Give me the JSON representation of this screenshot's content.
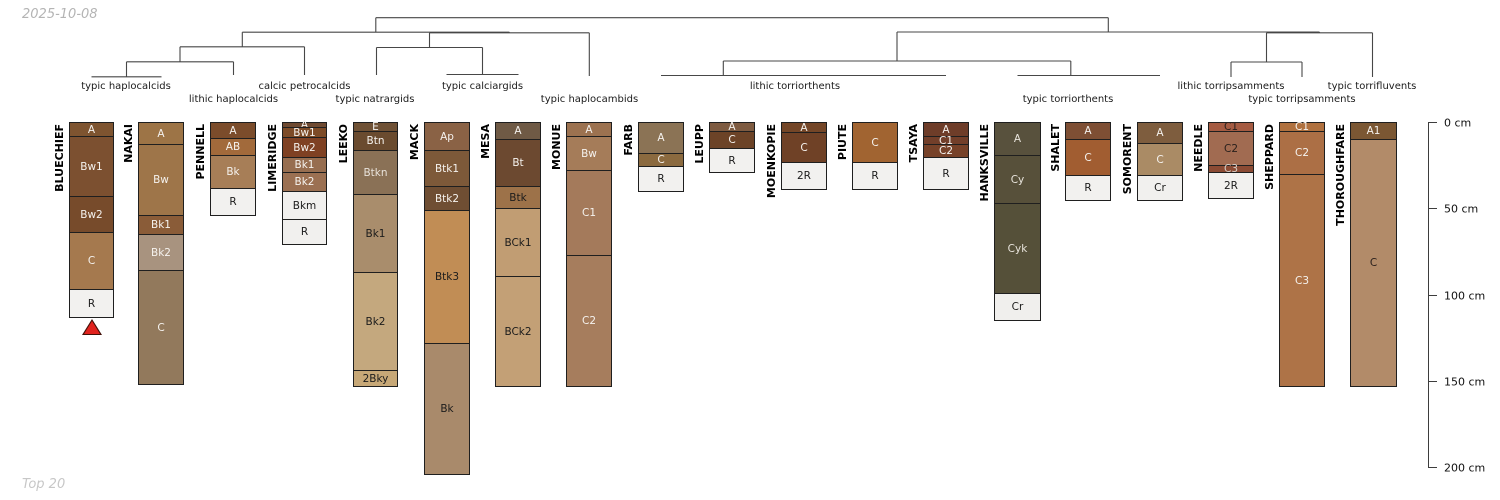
{
  "annotations": {
    "date": "2025-10-08",
    "footer": "Top 20"
  },
  "depth_axis": {
    "unit": "cm",
    "ticks": [
      0,
      50,
      100,
      150,
      200
    ],
    "tick_labels": [
      "0 cm",
      "50 cm",
      "100 cm",
      "150 cm",
      "200 cm"
    ]
  },
  "chart_data": {
    "type": "soil-profile-dendrogram",
    "title": "",
    "groups": [
      {
        "label": "typic haplocalcids",
        "x": 126,
        "row": 1
      },
      {
        "label": "lithic haplocalcids",
        "x": 233.5,
        "row": 2
      },
      {
        "label": "calcic petrocalcids",
        "x": 304.5,
        "row": 1
      },
      {
        "label": "typic natrargids",
        "x": 375,
        "row": 2
      },
      {
        "label": "typic calciargids",
        "x": 482.5,
        "row": 1
      },
      {
        "label": "typic haplocambids",
        "x": 589.5,
        "row": 2
      },
      {
        "label": "lithic torriorthents",
        "x": 795,
        "row": 1
      },
      {
        "label": "typic torriorthents",
        "x": 1068,
        "row": 2
      },
      {
        "label": "lithic torripsamments",
        "x": 1231,
        "row": 1
      },
      {
        "label": "typic torripsamments",
        "x": 1302,
        "row": 2
      },
      {
        "label": "typic torrifluvents",
        "x": 1372,
        "row": 1
      }
    ],
    "profiles": [
      {
        "name": "BLUECHIEF",
        "x": 69,
        "width": 45,
        "marker": "red-triangle",
        "horizons": [
          {
            "name": "A",
            "top": 0,
            "bottom": 8,
            "fill": "#7e5430",
            "text": "#f5f2ee"
          },
          {
            "name": "Bw1",
            "top": 8,
            "bottom": 43,
            "fill": "#7c5030",
            "text": "#f5f2ee"
          },
          {
            "name": "Bw2",
            "top": 43,
            "bottom": 64,
            "fill": "#774b2b",
            "text": "#f5f2ee"
          },
          {
            "name": "C",
            "top": 64,
            "bottom": 97,
            "fill": "#a5794e",
            "text": "#f5f2ee"
          },
          {
            "name": "R",
            "top": 97,
            "bottom": 113,
            "fill": "#f2f1ef",
            "text": "#1c1c1c"
          }
        ]
      },
      {
        "name": "NAKAI",
        "x": 138,
        "width": 46,
        "horizons": [
          {
            "name": "A",
            "top": 0,
            "bottom": 13,
            "fill": "#9d7446",
            "text": "#f5f2ee"
          },
          {
            "name": "Bw",
            "top": 13,
            "bottom": 54,
            "fill": "#9e7549",
            "text": "#f5f2ee"
          },
          {
            "name": "Bk1",
            "top": 54,
            "bottom": 65,
            "fill": "#8a5c38",
            "text": "#f5f2ee"
          },
          {
            "name": "Bk2",
            "top": 65,
            "bottom": 86,
            "fill": "#a8937f",
            "text": "#f5f2ee"
          },
          {
            "name": "C",
            "top": 86,
            "bottom": 152,
            "fill": "#92795c",
            "text": "#f5f2ee"
          }
        ]
      },
      {
        "name": "PENNELL",
        "x": 210,
        "width": 46,
        "horizons": [
          {
            "name": "A",
            "top": 0,
            "bottom": 9,
            "fill": "#7b4c2b",
            "text": "#f5f2ee"
          },
          {
            "name": "AB",
            "top": 9,
            "bottom": 19,
            "fill": "#a26a3b",
            "text": "#f5f2ee"
          },
          {
            "name": "Bk",
            "top": 19,
            "bottom": 38,
            "fill": "#a77e57",
            "text": "#f5f2ee"
          },
          {
            "name": "R",
            "top": 38,
            "bottom": 54,
            "fill": "#f2f1ef",
            "text": "#1c1c1c"
          }
        ]
      },
      {
        "name": "LIMERIDGE",
        "x": 282,
        "width": 45,
        "horizons": [
          {
            "name": "A",
            "top": 0,
            "bottom": 3,
            "fill": "#6f4a31",
            "text": "#f5f2ee"
          },
          {
            "name": "Bw1",
            "top": 3,
            "bottom": 8.5,
            "fill": "#7d4b27",
            "text": "#f5f2ee"
          },
          {
            "name": "Bw2",
            "top": 8.5,
            "bottom": 20,
            "fill": "#7f4123",
            "text": "#f5f2ee"
          },
          {
            "name": "Bk1",
            "top": 20,
            "bottom": 29,
            "fill": "#976e50",
            "text": "#f5f2ee"
          },
          {
            "name": "Bk2",
            "top": 29,
            "bottom": 40,
            "fill": "#9b7052",
            "text": "#f5f2ee"
          },
          {
            "name": "Bkm",
            "top": 40,
            "bottom": 56,
            "fill": "#f1f0ee",
            "text": "#1c1c1c"
          },
          {
            "name": "R",
            "top": 56,
            "bottom": 71,
            "fill": "#f1f0ee",
            "text": "#1c1c1c"
          }
        ]
      },
      {
        "name": "LEEKO",
        "x": 353,
        "width": 45,
        "horizons": [
          {
            "name": "E",
            "top": 0,
            "bottom": 5,
            "fill": "#6f5135",
            "text": "#f5f2ee"
          },
          {
            "name": "Btn",
            "top": 5,
            "bottom": 16,
            "fill": "#6a4b2f",
            "text": "#f5f2ee"
          },
          {
            "name": "Btkn",
            "top": 16,
            "bottom": 42,
            "fill": "#8a7156",
            "text": "#e8e2da"
          },
          {
            "name": "Bk1",
            "top": 42,
            "bottom": 87,
            "fill": "#a98d6c",
            "text": "#1c1c1c"
          },
          {
            "name": "Bk2",
            "top": 87,
            "bottom": 144,
            "fill": "#c4a87e",
            "text": "#1c1c1c"
          },
          {
            "name": "2Bky",
            "top": 144,
            "bottom": 153,
            "fill": "#c7a877",
            "text": "#1c1c1c"
          }
        ]
      },
      {
        "name": "MACK",
        "x": 424,
        "width": 46,
        "horizons": [
          {
            "name": "Ap",
            "top": 0,
            "bottom": 16,
            "fill": "#8a6245",
            "text": "#f5f2ee"
          },
          {
            "name": "Btk1",
            "top": 16,
            "bottom": 37,
            "fill": "#7d5939",
            "text": "#f5f2ee"
          },
          {
            "name": "Btk2",
            "top": 37,
            "bottom": 51,
            "fill": "#6f4e33",
            "text": "#f5f2ee"
          },
          {
            "name": "Btk3",
            "top": 51,
            "bottom": 128,
            "fill": "#c18d55",
            "text": "#1c1c1c"
          },
          {
            "name": "Bk",
            "top": 128,
            "bottom": 204,
            "fill": "#a98a6b",
            "text": "#1c1c1c"
          }
        ]
      },
      {
        "name": "MESA",
        "x": 495,
        "width": 46,
        "horizons": [
          {
            "name": "A",
            "top": 0,
            "bottom": 10,
            "fill": "#6f5a45",
            "text": "#f5f2ee"
          },
          {
            "name": "Bt",
            "top": 10,
            "bottom": 37,
            "fill": "#6c4930",
            "text": "#f5f2ee"
          },
          {
            "name": "Btk",
            "top": 37,
            "bottom": 50,
            "fill": "#9d7249",
            "text": "#1c1c1c"
          },
          {
            "name": "BCk1",
            "top": 50,
            "bottom": 89,
            "fill": "#c19d73",
            "text": "#1c1c1c"
          },
          {
            "name": "BCk2",
            "top": 89,
            "bottom": 153,
            "fill": "#c3a076",
            "text": "#1c1c1c"
          }
        ]
      },
      {
        "name": "MONUE",
        "x": 566,
        "width": 46,
        "horizons": [
          {
            "name": "A",
            "top": 0,
            "bottom": 8,
            "fill": "#9c7250",
            "text": "#f5f2ee"
          },
          {
            "name": "Bw",
            "top": 8,
            "bottom": 28,
            "fill": "#a57c59",
            "text": "#f5f2ee"
          },
          {
            "name": "C1",
            "top": 28,
            "bottom": 77,
            "fill": "#a47a5b",
            "text": "#f5f2ee"
          },
          {
            "name": "C2",
            "top": 77,
            "bottom": 153,
            "fill": "#a67d5d",
            "text": "#f5f2ee"
          }
        ]
      },
      {
        "name": "FARB",
        "x": 638,
        "width": 46,
        "horizons": [
          {
            "name": "A",
            "top": 0,
            "bottom": 18,
            "fill": "#8b7355",
            "text": "#f5f2ee"
          },
          {
            "name": "C",
            "top": 18,
            "bottom": 25.5,
            "fill": "#8b6a3f",
            "text": "#f5f2ee"
          },
          {
            "name": "R",
            "top": 25.5,
            "bottom": 40,
            "fill": "#f2f1ef",
            "text": "#1c1c1c"
          }
        ]
      },
      {
        "name": "LEUPP",
        "x": 709,
        "width": 46,
        "horizons": [
          {
            "name": "A",
            "top": 0,
            "bottom": 5,
            "fill": "#7e5b41",
            "text": "#f5f2ee"
          },
          {
            "name": "C",
            "top": 5,
            "bottom": 15,
            "fill": "#6c4327",
            "text": "#f5f2ee"
          },
          {
            "name": "R",
            "top": 15,
            "bottom": 29,
            "fill": "#f2f1ef",
            "text": "#1c1c1c"
          }
        ]
      },
      {
        "name": "MOENKOPIE",
        "x": 781,
        "width": 46,
        "horizons": [
          {
            "name": "A",
            "top": 0,
            "bottom": 6,
            "fill": "#744627",
            "text": "#f5f2ee"
          },
          {
            "name": "C",
            "top": 6,
            "bottom": 23,
            "fill": "#6f4126",
            "text": "#f5f2ee"
          },
          {
            "name": "2R",
            "top": 23,
            "bottom": 39,
            "fill": "#f2f1ef",
            "text": "#1c1c1c"
          }
        ]
      },
      {
        "name": "PIUTE",
        "x": 852,
        "width": 46,
        "horizons": [
          {
            "name": "C",
            "top": 0,
            "bottom": 23,
            "fill": "#a16431",
            "text": "#f5f2ee"
          },
          {
            "name": "R",
            "top": 23,
            "bottom": 39,
            "fill": "#f2f1ef",
            "text": "#1c1c1c"
          }
        ]
      },
      {
        "name": "TSAYA",
        "x": 923,
        "width": 46,
        "horizons": [
          {
            "name": "A",
            "top": 0,
            "bottom": 8,
            "fill": "#6e3d29",
            "text": "#f5f2ee"
          },
          {
            "name": "C1",
            "top": 8,
            "bottom": 13,
            "fill": "#723f2a",
            "text": "#f5f2ee"
          },
          {
            "name": "C2",
            "top": 13,
            "bottom": 20,
            "fill": "#774229",
            "text": "#f5f2ee"
          },
          {
            "name": "R",
            "top": 20,
            "bottom": 39,
            "fill": "#f2f1ef",
            "text": "#1c1c1c"
          }
        ]
      },
      {
        "name": "HANKSVILLE",
        "x": 994,
        "width": 47,
        "horizons": [
          {
            "name": "A",
            "top": 0,
            "bottom": 19,
            "fill": "#58513d",
            "text": "#e8e4dc"
          },
          {
            "name": "Cy",
            "top": 19,
            "bottom": 47,
            "fill": "#57503a",
            "text": "#e8e4dc"
          },
          {
            "name": "Cyk",
            "top": 47,
            "bottom": 99,
            "fill": "#555039",
            "text": "#e8e4dc"
          },
          {
            "name": "Cr",
            "top": 99,
            "bottom": 115,
            "fill": "#f0efed",
            "text": "#1c1c1c"
          }
        ]
      },
      {
        "name": "SHALET",
        "x": 1065,
        "width": 46,
        "horizons": [
          {
            "name": "A",
            "top": 0,
            "bottom": 10,
            "fill": "#7e4f34",
            "text": "#f5f2ee"
          },
          {
            "name": "C",
            "top": 10,
            "bottom": 31,
            "fill": "#a15d31",
            "text": "#f5f2ee"
          },
          {
            "name": "R",
            "top": 31,
            "bottom": 45,
            "fill": "#f2f1ef",
            "text": "#1c1c1c"
          }
        ]
      },
      {
        "name": "SOMORENT",
        "x": 1137,
        "width": 46,
        "horizons": [
          {
            "name": "A",
            "top": 0,
            "bottom": 12,
            "fill": "#7e5d3e",
            "text": "#f5f2ee"
          },
          {
            "name": "C",
            "top": 12,
            "bottom": 31,
            "fill": "#aa8b65",
            "text": "#f5f2ee"
          },
          {
            "name": "Cr",
            "top": 31,
            "bottom": 45,
            "fill": "#f1f0ee",
            "text": "#1c1c1c"
          }
        ]
      },
      {
        "name": "NEEDLE",
        "x": 1208,
        "width": 46,
        "horizons": [
          {
            "name": "C1",
            "top": 0,
            "bottom": 5,
            "fill": "#a55b42",
            "text": "#2a201c"
          },
          {
            "name": "C2",
            "top": 5,
            "bottom": 25,
            "fill": "#a16b51",
            "text": "#2a201c"
          },
          {
            "name": "C3",
            "top": 25,
            "bottom": 29,
            "fill": "#8b4b34",
            "text": "#d8cfc8"
          },
          {
            "name": "2R",
            "top": 29,
            "bottom": 44,
            "fill": "#f2f1ef",
            "text": "#1c1c1c"
          }
        ]
      },
      {
        "name": "SHEPPARD",
        "x": 1279,
        "width": 46,
        "horizons": [
          {
            "name": "C1",
            "top": 0,
            "bottom": 5,
            "fill": "#b0713f",
            "text": "#f5f2ee"
          },
          {
            "name": "C2",
            "top": 5,
            "bottom": 30,
            "fill": "#ac6f45",
            "text": "#f5f2ee"
          },
          {
            "name": "C3",
            "top": 30,
            "bottom": 153,
            "fill": "#ae7347",
            "text": "#f5f2ee"
          }
        ]
      },
      {
        "name": "THOROUGHFARE",
        "x": 1350,
        "width": 47,
        "horizons": [
          {
            "name": "A1",
            "top": 0,
            "bottom": 10,
            "fill": "#7b5733",
            "text": "#f5f2ee"
          },
          {
            "name": "C",
            "top": 10,
            "bottom": 153,
            "fill": "#b28b69",
            "text": "#2a201c"
          }
        ]
      }
    ],
    "dendrogram_segments": [
      [
        91.5,
        76.8,
        161.5,
        76.8
      ],
      [
        126.5,
        61.8,
        126.5,
        76.8
      ],
      [
        126.5,
        61.8,
        233.5,
        61.8
      ],
      [
        233.5,
        61.8,
        233.5,
        75
      ],
      [
        180,
        46.8,
        180,
        61.8
      ],
      [
        180,
        46.8,
        304.5,
        46.8
      ],
      [
        304.5,
        46.8,
        304.5,
        75
      ],
      [
        242.3,
        32.2,
        242.3,
        46.8
      ],
      [
        446.5,
        74.5,
        518.5,
        74.5
      ],
      [
        482.5,
        47.5,
        482.5,
        74.5
      ],
      [
        376.5,
        47.5,
        482.5,
        47.5
      ],
      [
        376.5,
        47.5,
        376.5,
        75
      ],
      [
        429.5,
        32.8,
        429.5,
        47.5
      ],
      [
        429.5,
        32.8,
        589.3,
        32.8
      ],
      [
        589.3,
        32.8,
        589.3,
        76
      ],
      [
        509.4,
        32.2,
        509.4,
        32.8
      ],
      [
        242.3,
        32.2,
        509.4,
        32.2
      ],
      [
        375.8,
        17.7,
        375.8,
        32.2
      ],
      [
        375.8,
        17.7,
        1108.3,
        17.7
      ],
      [
        661,
        75.5,
        946,
        75.5
      ],
      [
        723.3,
        61,
        723.3,
        75.5
      ],
      [
        723.3,
        61,
        1070.8,
        61
      ],
      [
        897,
        32,
        897,
        61
      ],
      [
        1017.5,
        75.5,
        1160,
        75.5
      ],
      [
        1070.8,
        61,
        1070.8,
        75.5
      ],
      [
        897,
        32,
        1319.5,
        32
      ],
      [
        1108.3,
        17.7,
        1108.3,
        32
      ],
      [
        1231,
        62,
        1302,
        62
      ],
      [
        1231,
        62,
        1231,
        77
      ],
      [
        1302,
        62,
        1302,
        77
      ],
      [
        1266.5,
        32.8,
        1266.5,
        62
      ],
      [
        1266.5,
        32.8,
        1372.5,
        32.8
      ],
      [
        1372.5,
        32.8,
        1372.5,
        77
      ],
      [
        1319.5,
        32,
        1319.5,
        32.8
      ]
    ],
    "colors": {
      "dendrogram_line": "#474747",
      "horizon_border": "#1f1f1f",
      "marker_red": "#e1231e"
    }
  }
}
